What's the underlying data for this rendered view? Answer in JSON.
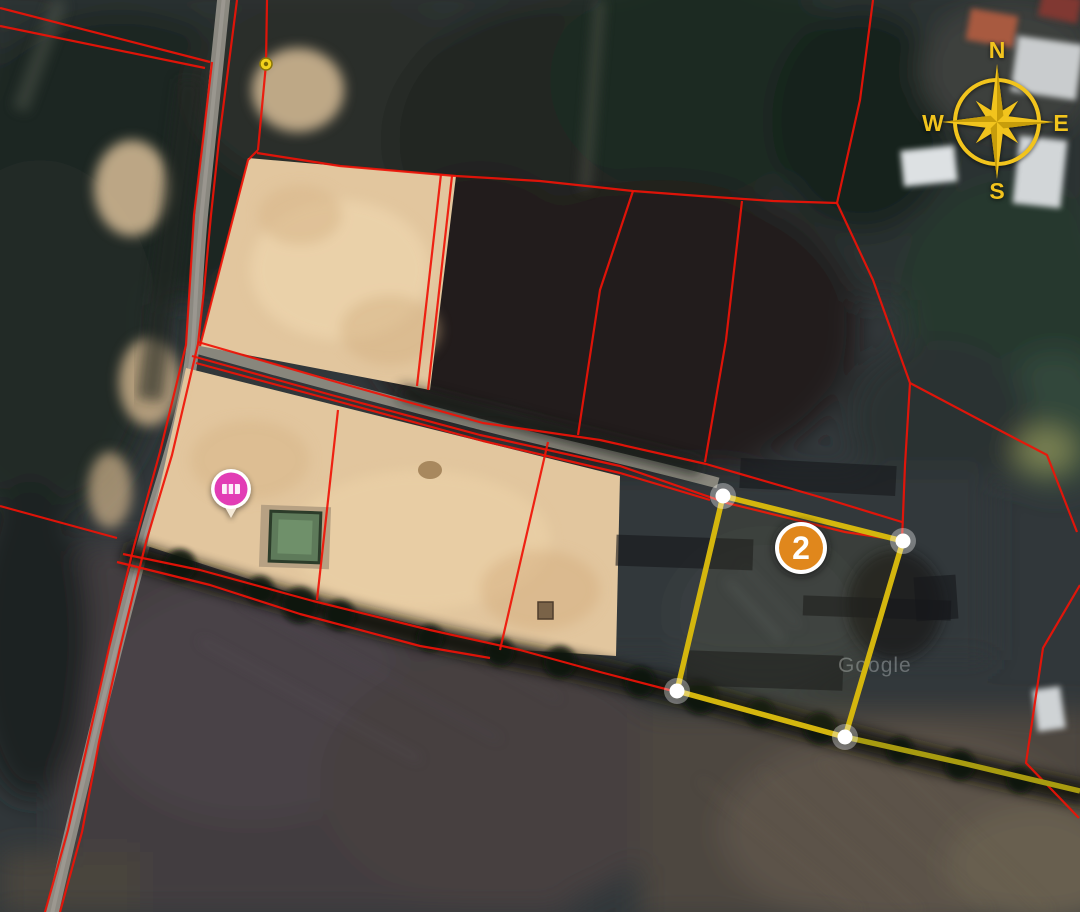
{
  "map": {
    "watermark": "Google",
    "compass": {
      "labels": {
        "n": "N",
        "e": "E",
        "s": "S",
        "w": "W"
      },
      "color": "#f2c41d"
    },
    "plot_marker": {
      "label": "2",
      "fill": "#e0871c",
      "x": 801,
      "y": 548
    },
    "listing_pin": {
      "fill": "#e23db5",
      "x": 231,
      "y": 489
    },
    "waypoint_pin": {
      "fill": "#f2d21c",
      "x": 266,
      "y": 64
    },
    "colors": {
      "boundary_red": "#ef1206",
      "highlight_yellow": "#d4b60e",
      "highlight_ext": "#a89b10",
      "vertex_white": "#ffffff",
      "tan_parcel": "#e2c69e",
      "compass_gold": "#f2c41d"
    },
    "highlight_plot": {
      "outline": "723,496 903,541 845,737 677,691",
      "extension": "845,737 962,763 1080,791",
      "vertices": [
        [
          723,
          496
        ],
        [
          903,
          541
        ],
        [
          845,
          737
        ],
        [
          677,
          691
        ]
      ]
    },
    "boundary_lines": [
      "0,8 210,62",
      "0,26 205,68",
      "212,62 203,140 194,215 190,282 186,345 160,452 134,546 109,648 88,742 68,830 45,912",
      "237,0 228,70 219,140 211,215 204,290 198,344 172,455 146,542 120,648 99,742 82,832 60,912",
      "267,0 266,64 258,150",
      "258,150 248,160 200,346",
      "257,153 340,166 456,176 540,181 633,191 700,196 773,201 837,203",
      "837,203 860,100 873,0",
      "837,203 873,280 910,383",
      "910,383 980,420 1047,455 1077,532",
      "910,383 905,465 902,540",
      "633,191 600,290 578,435",
      "742,201 726,340 705,462",
      "452,176 428,390",
      "441,174 417,386",
      "198,342 340,383 483,423 600,440 706,464 830,500 902,522",
      "192,356 335,396 480,435 620,466 727,503 845,532 898,540",
      "196,363 340,402 483,441 620,473 710,500",
      "338,410 317,600",
      "548,442 500,650",
      "123,554 200,570 313,601 430,630 520,650 600,672 677,692",
      "677,692 845,737 1080,791",
      "117,562 210,585 300,614 420,646 490,658",
      "0,506 117,538",
      "1080,585 1043,648 1026,763 1079,818"
    ],
    "redaction_bars": [
      {
        "x": 740,
        "y": 462,
        "w": 156,
        "h": 30,
        "r": 3
      },
      {
        "x": 616,
        "y": 537,
        "w": 137,
        "h": 31,
        "r": 2
      },
      {
        "x": 803,
        "y": 598,
        "w": 148,
        "h": 20,
        "r": 2
      },
      {
        "x": 687,
        "y": 653,
        "w": 156,
        "h": 35,
        "r": 2
      },
      {
        "x": 915,
        "y": 576,
        "w": 42,
        "h": 44,
        "r": -4
      }
    ]
  }
}
